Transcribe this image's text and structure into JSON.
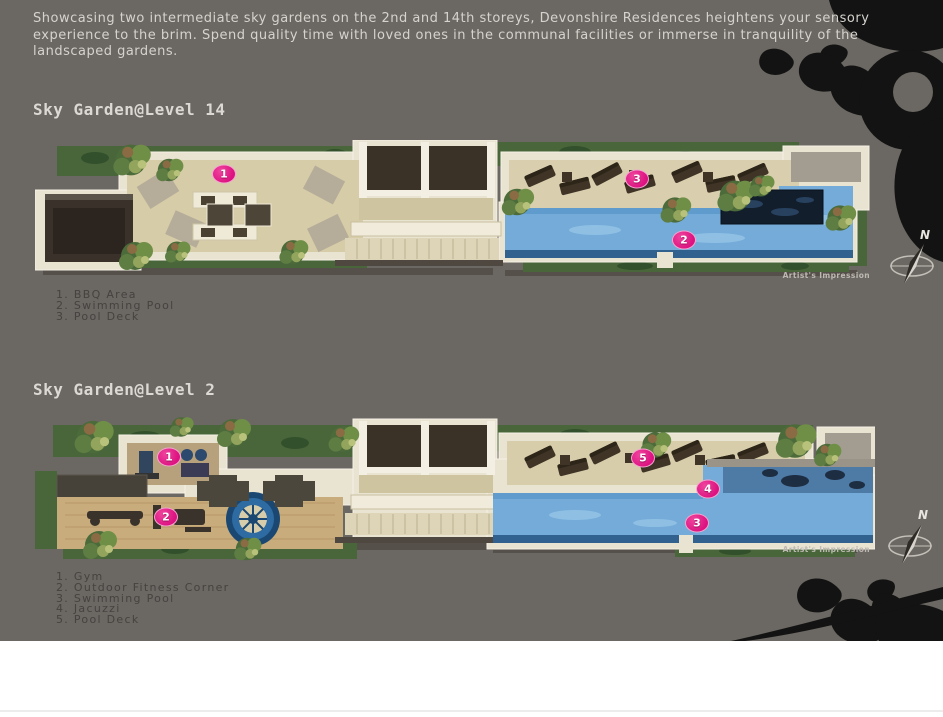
{
  "intro_text": "Showcasing two intermediate sky gardens on the 2nd and 14th storeys, Devonshire Residences heightens your sensory experience to the brim. Spend quality time with loved ones in the communal facilities or immerse in tranquility of the landscaped gardens.",
  "artists_impression_label": "Artist's Impression",
  "compass": {
    "north_label": "N"
  },
  "sections": {
    "level14": {
      "title": "Sky Garden@Level 14",
      "legend": [
        "1. BBQ Area",
        "2. Swimming Pool",
        "3. Pool Deck"
      ],
      "markers": [
        "1",
        "2",
        "3"
      ]
    },
    "level2": {
      "title": "Sky Garden@Level 2",
      "legend": [
        "1. Gym",
        "2. Outdoor Fitness Corner",
        "3. Swimming Pool",
        "4. Jacuzzi",
        "5. Pool Deck"
      ],
      "markers": [
        "1",
        "2",
        "3",
        "4",
        "5"
      ]
    }
  },
  "colors": {
    "background": "#6B6762",
    "accent_pink": "#E01883",
    "pool_blue": "#74ABD8",
    "petal_black": "#131313",
    "heading_text": "#DCD9D4",
    "body_text": "#D6D3CE",
    "legend_text": "#454240"
  }
}
